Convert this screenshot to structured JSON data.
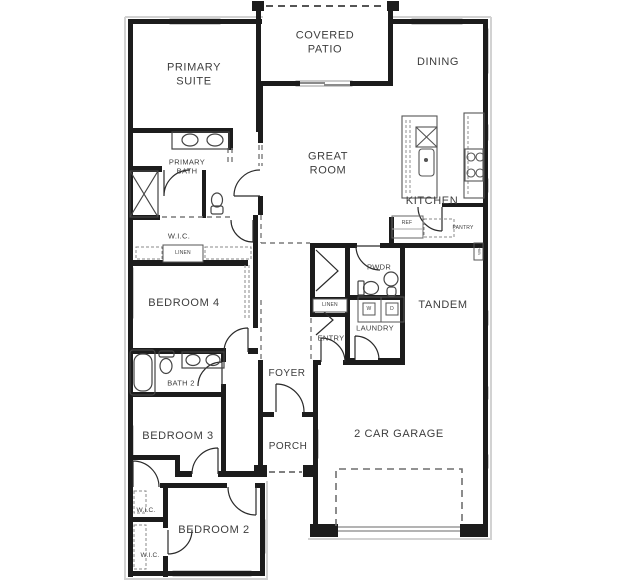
{
  "title": "Single story floor plan",
  "rooms": {
    "covered_patio": "COVERED\nPATIO",
    "primary_suite": "PRIMARY\nSUITE",
    "dining": "DINING",
    "great_room": "GREAT\nROOM",
    "kitchen": "KITCHEN",
    "primary_bath": "PRIMARY\nBATH",
    "wic_primary": "W.I.C.",
    "linen_primary": "LINEN",
    "bedroom_4": "BEDROOM 4",
    "ref": "REF",
    "pantry": "PANTRY",
    "pwdr": "PWDR",
    "linen_hall": "LINEN",
    "tandem": "TANDEM",
    "washer": "W",
    "dryer": "D",
    "laundry": "LAUNDRY",
    "entry": "ENTRY",
    "bath_2": "BATH 2",
    "foyer": "FOYER",
    "bedroom_3": "BEDROOM 3",
    "porch": "PORCH",
    "garage": "2 CAR GARAGE",
    "wic_hall": "W.I.C.",
    "bedroom_2": "BEDROOM 2",
    "wic_bedroom2": "W.I.C.",
    "water_heater": "W/H"
  },
  "colors": {
    "wall": "#1c1c1c",
    "window": "#f0f0f0",
    "window_edge": "#9a9a9a",
    "label": "#3d3d3d",
    "shadow": "#d2d2d2",
    "background": "#ffffff"
  }
}
